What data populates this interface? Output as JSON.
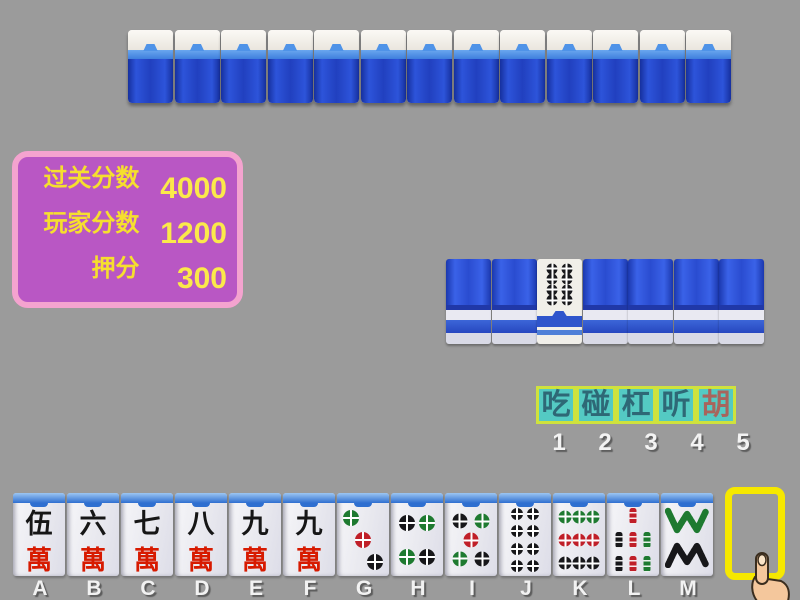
{
  "colors": {
    "background": "#9b9b9b",
    "tile_back_blue": "#2a4cd0",
    "score_panel_bg": "#b957c4",
    "score_panel_border": "#f4a3cf",
    "score_text": "#f6df2e",
    "button_bg": "#54cac3",
    "button_border": "#cfe23d",
    "button_text": "#2e6876",
    "button_hu_text": "#a8645c",
    "slot_border": "#f6e800",
    "dot_green": "#1e7a30",
    "dot_red": "#c01f28",
    "dot_black": "#17171a"
  },
  "opponent_top": {
    "tile_count": 13
  },
  "opponent_right": {
    "tile_count": 7,
    "face_up_index": 2,
    "face_up_tile": {
      "suit": "dots",
      "value": 8
    }
  },
  "score_panel": {
    "rows": [
      {
        "label": "过关分数",
        "value": "4000"
      },
      {
        "label": "玩家分数",
        "value": "1200"
      },
      {
        "label": "押分",
        "value": "300"
      }
    ]
  },
  "actions": {
    "buttons": [
      {
        "label": "吃",
        "number": "1",
        "highlight": false
      },
      {
        "label": "碰",
        "number": "2",
        "highlight": false
      },
      {
        "label": "杠",
        "number": "3",
        "highlight": false
      },
      {
        "label": "听",
        "number": "4",
        "highlight": false
      },
      {
        "label": "胡",
        "number": "5",
        "highlight": true
      }
    ]
  },
  "hand": {
    "tiles": [
      {
        "key": "A",
        "suit": "wan",
        "top_char": "伍",
        "bottom_char": "萬"
      },
      {
        "key": "B",
        "suit": "wan",
        "top_char": "六",
        "bottom_char": "萬"
      },
      {
        "key": "C",
        "suit": "wan",
        "top_char": "七",
        "bottom_char": "萬"
      },
      {
        "key": "D",
        "suit": "wan",
        "top_char": "八",
        "bottom_char": "萬"
      },
      {
        "key": "E",
        "suit": "wan",
        "top_char": "九",
        "bottom_char": "萬"
      },
      {
        "key": "F",
        "suit": "wan",
        "top_char": "九",
        "bottom_char": "萬"
      },
      {
        "key": "G",
        "suit": "dots",
        "value": 3
      },
      {
        "key": "H",
        "suit": "dots",
        "value": 4
      },
      {
        "key": "I",
        "suit": "dots",
        "value": 5
      },
      {
        "key": "J",
        "suit": "dots",
        "value": 8
      },
      {
        "key": "K",
        "suit": "dots",
        "value": 9
      },
      {
        "key": "L",
        "suit": "bamboo",
        "value": 7
      },
      {
        "key": "M",
        "suit": "bamboo",
        "value": 8
      }
    ]
  },
  "draw_slot": {
    "key": "N"
  }
}
